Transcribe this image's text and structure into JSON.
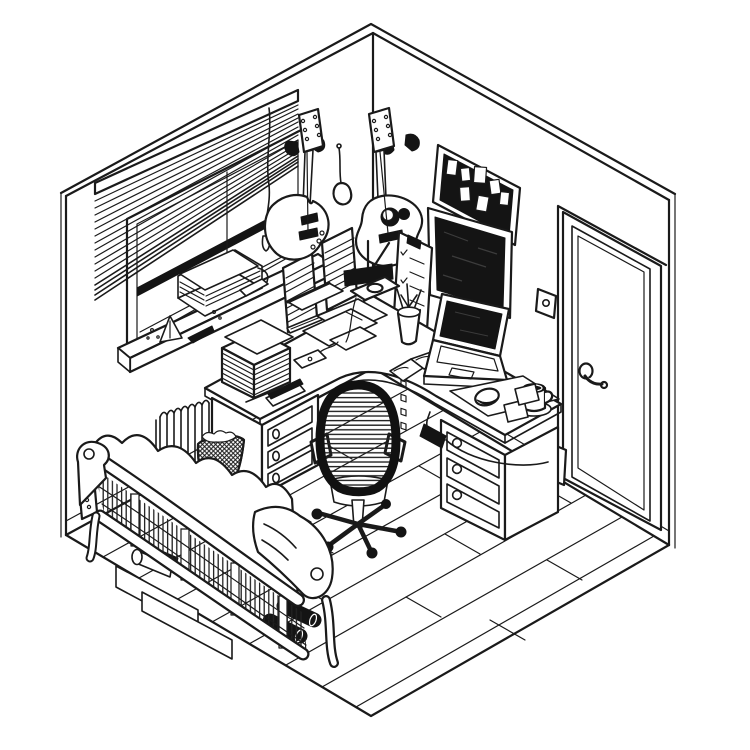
{
  "scene": {
    "title": "Hand-drawn isometric ink illustration of a corner home office and music room",
    "description": "Black pen line-art, isometric view into a room corner: window with venetian blinds over a radiator, two guitars hanging on the wall, corkboard, wall monitor, checklist, door, L-shaped corner desk with laptop, lamp, books and mug, mesh office chair, wooden-frame sofa and plank floor.",
    "style": "black ink on white paper",
    "palette": {
      "background": "#ffffff",
      "ink": "#1a1a1a",
      "fill_dark": "#141414",
      "paper": "#ffffff"
    }
  },
  "objects": {
    "room_shell": "two walls meeting in a corner with baseboards and plank floor",
    "floor_planks": "wooden floorboards running parallel to the left wall",
    "window": "double-hung window on the left wall with deep sill",
    "blinds": "venetian blinds, raised unevenly, pull cord hanging on the right",
    "windowsill_items": "stack of papers, metronome, small tray and clutter on the sill",
    "radiator": "finned radiator below the window",
    "electric_guitar": "electric guitar hanging from a wall hook on the left wall",
    "hanging_capo": "small capo/shaker hanging from a nail between the guitars",
    "acoustic_guitar": "acoustic guitar hanging from a wall hook on the right wall",
    "wall_clipboards": "two sheet-music pages pinned to the left wall",
    "checklist_board": "clipboard with checkboxes on the right wall",
    "corkboard": "dark corkboard with pinned white notes",
    "monitor": "large dark wall monitor above the desk",
    "light_switch": "light switch plate beside the door",
    "door": "panel door with lever handle on the right wall",
    "outlet_right": "power outlet low on the right wall",
    "outlet_left": "power outlet low on the left wall",
    "corner_desk": "L-shaped corner desk with curved inner edge",
    "pedestal_left": "three-drawer pedestal under the left desk return",
    "pedestal_right": "three-drawer pedestal under the right desk return",
    "book_stack": "tall pile of books and papers on the left desk end",
    "desk_lamp": "architect desk lamp with dark head at the room corner",
    "paper_sheets": "loose paper sheets scattered on the desk",
    "pencil_cup": "cup of pens and pencils",
    "open_book": "open notebook beside the laptop",
    "laptop": "open laptop with dark screen",
    "mousepad_mouse": "mousepad with mouse",
    "coffee_mug": "coffee mug on a small plate",
    "sticky_notes": "two sticky notes on the desk",
    "stapler": "stapler and pencil on the desk",
    "phone": "phone with short cord on the desk edge",
    "power_brick": "power brick and cable running to the wall outlet",
    "office_chair": "mesh-back office chair on a five-star caster base",
    "waste_basket": "woven wicker waste basket with crumpled paper",
    "sofa": "wood-framed futon sofa seen from behind with cushions and scrolled arms",
    "under_sofa_storage": "flat boxes and a roll stored under the sofa",
    "dumbbells": "two dark dumbbells under the sofa edge"
  }
}
